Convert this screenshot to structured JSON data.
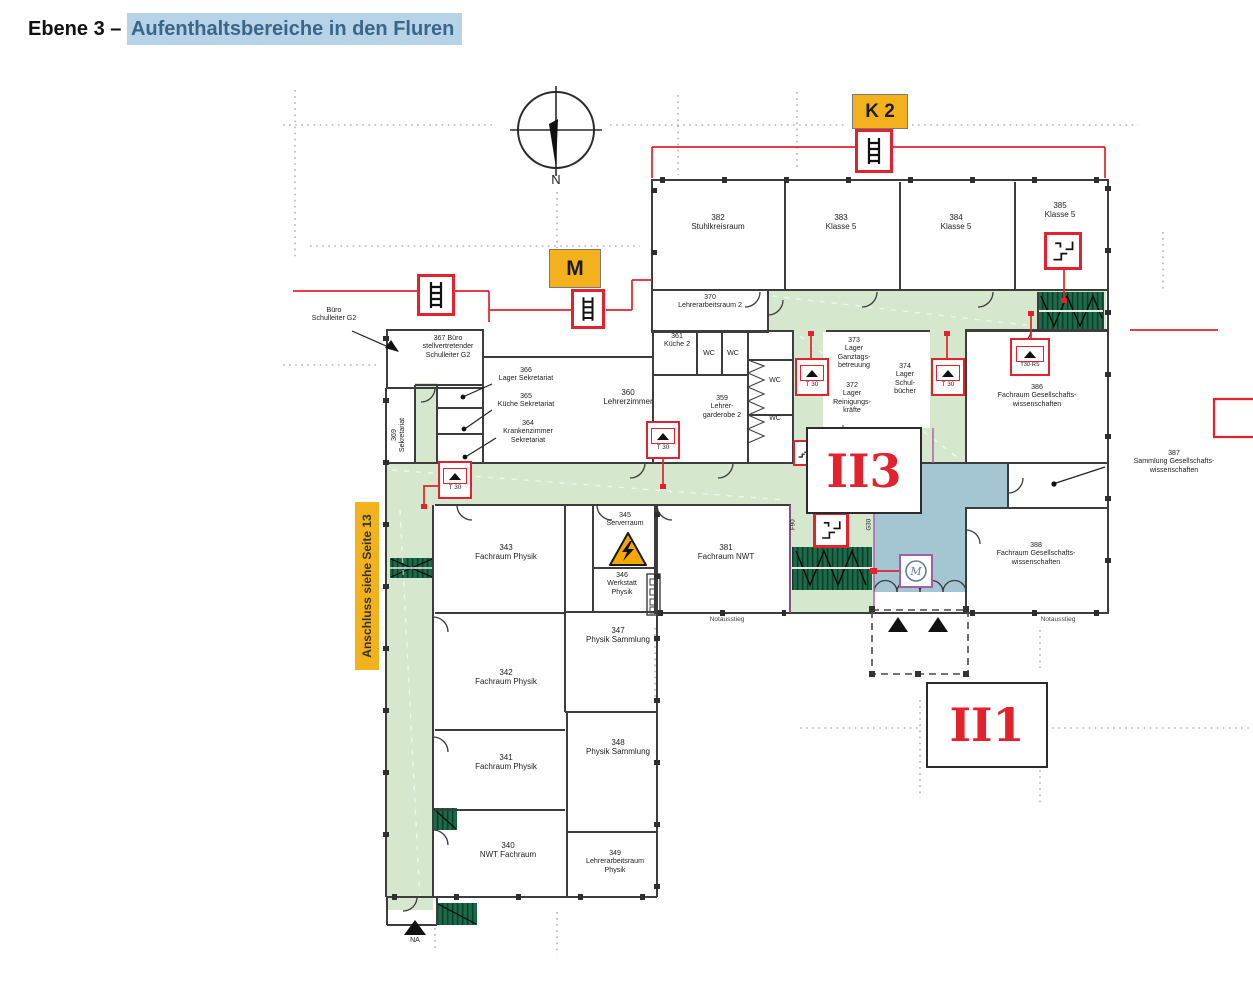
{
  "title": {
    "prefix": "Ebene 3 – ",
    "highlight": "Aufenthaltsbereiche in den Fluren"
  },
  "markers": {
    "k2": "K 2",
    "m": "M",
    "anschluss": "Anschluss siehe Seite 13",
    "zone_ii3": "II3",
    "zone_ii1": "II1",
    "na": "NA",
    "compass_n": "N"
  },
  "fire_labels": {
    "f90": "F90",
    "g30": "G30"
  },
  "door_labels": {
    "t30": "T 30",
    "t30_rs": "T30-RS"
  },
  "rooms": {
    "r382": "382\nStuhlkreisraum",
    "r383": "383\nKlasse 5",
    "r384": "384\nKlasse 5",
    "r385": "385\nKlasse 5",
    "r370": "370\nLehrerarbeitsraum 2",
    "r361": "361\nKüche 2",
    "r367": "367 Büro\nstellvertretender\nSchulleiter G2",
    "r366": "366\nLager Sekretariat",
    "r365": "365\nKüche Sekretariat",
    "r364": "364\nKrankenzimmer\nSekretariat",
    "r369": "369\nSekretariat",
    "r360": "360\nLehrerzimmer",
    "r359": "359\nLehrer-\ngarderobe 2",
    "r373": "373\nLager\nGanztags-\nbetreuung",
    "r372": "372\nLager\nReinigungs-\nkräfte",
    "r374": "374\nLager\nSchul-\nbücher",
    "r386": "386\nFachraum Gesellschafts-\nwissenschaften",
    "r387": "387\nSammlung Gesellschafts-\nwissenschaften",
    "r388": "388\nFachraum Gesellschafts-\nwissenschaften",
    "r345": "345\nServerraum",
    "r346": "346\nWerkstatt\nPhysik",
    "r381": "381\nFachraum NWT",
    "r343": "343\nFachraum Physik",
    "r342": "342\nFachraum Physik",
    "r341": "341\nFachraum Physik",
    "r340": "340\nNWT Fachraum",
    "r347": "347\nPhysik Sammlung",
    "r348": "348\nPhysik Sammlung",
    "r349": "349\nLehrerarbeitsraum\nPhysik"
  },
  "annotations": {
    "buero_schulleiter": "Büro\nSchulleiter G2",
    "wc": "WC",
    "notausstieg": "Notausstieg"
  },
  "colors": {
    "corridor_green": "#d5e7cc",
    "stair_green": "#1e6b4a",
    "zone_blue": "#a4c6d2",
    "signal_red": "#e2222e",
    "marker_orange": "#f3b11d",
    "title_highlight": "#b7d3e8"
  }
}
